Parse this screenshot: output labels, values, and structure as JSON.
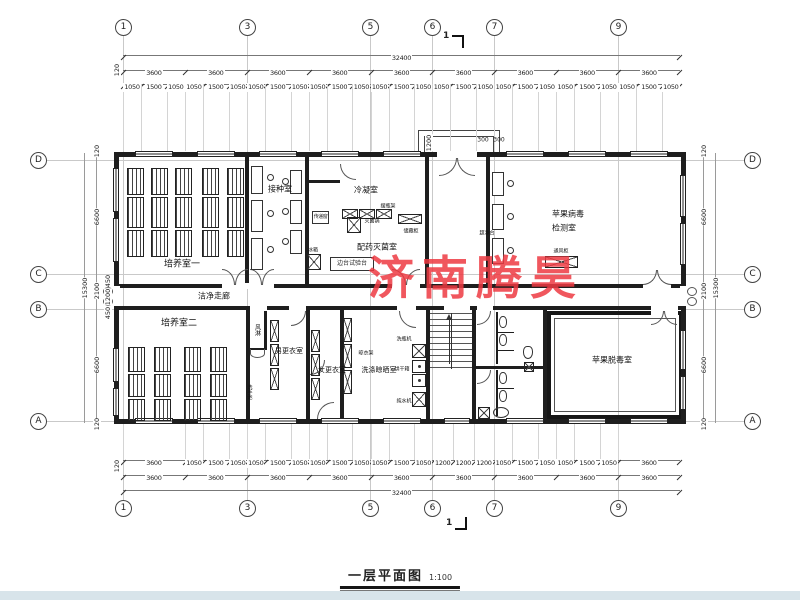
{
  "watermark": {
    "text": "济南腾昊",
    "color": "#ee3a42"
  },
  "title": {
    "name": "一层平面图",
    "scale": "1:100"
  },
  "section_mark": {
    "label": "1"
  },
  "axes": {
    "cols": [
      "1",
      "3",
      "5",
      "6",
      "7",
      "9"
    ],
    "rows": [
      "D",
      "C",
      "B",
      "A"
    ]
  },
  "dims": {
    "top": {
      "total": "32400",
      "edge": "120",
      "bays": [
        "3600",
        "3600",
        "3600",
        "3600",
        "3600",
        "3600",
        "3600",
        "3600",
        "3600"
      ],
      "fine": [
        "1050",
        "1500",
        "1050",
        "1050",
        "1500",
        "1050",
        "1050",
        "1500",
        "1050",
        "1050",
        "1500",
        "1050",
        "1050",
        "1500",
        "1050",
        "1050",
        "1500",
        "1050",
        "1050",
        "1500",
        "1050",
        "1050",
        "1500",
        "1050",
        "1050",
        "1500",
        "1050"
      ]
    },
    "bottom": {
      "total": "32400",
      "edge": "120",
      "bays": [
        "3600",
        "3600",
        "3600",
        "3600",
        "3600",
        "3600",
        "3600",
        "3600",
        "3600"
      ],
      "fine": [
        "3600",
        "1050",
        "1500",
        "1050",
        "1050",
        "1500",
        "1050",
        "1050",
        "1500",
        "1050",
        "1050",
        "1500",
        "1050",
        "1200",
        "1200",
        "1200",
        "1050",
        "1500",
        "1050",
        "1050",
        "1500",
        "1050",
        "3600"
      ]
    },
    "left": {
      "edge_top": "120",
      "d_to_c": "6600",
      "c_to_b": "2100",
      "b_to_a": "6600",
      "edge_bottom": "120",
      "total": "15300",
      "sub": [
        "450",
        "1200",
        "450"
      ]
    },
    "right": {
      "edge_top": "120",
      "d_to_c": "6600",
      "c_to_b": "2100",
      "b_to_a": "6600",
      "edge_bottom": "120",
      "total": "15300"
    },
    "porch": {
      "depth": "1200",
      "col1": "300",
      "col2": "300"
    }
  },
  "rooms": {
    "culture1": "培养室一",
    "inoculation": "接种室",
    "condensing": "冷凝室",
    "prep": "配药灭菌室",
    "virus_test_line1": "苹果病毒",
    "virus_test_line2": "检测室",
    "corridor": "洁净走廊",
    "culture2": "培养室二",
    "men_change": "男更衣室",
    "women_change": "女更衣室",
    "washing": "洗涤晾晒室",
    "detox": "苹果脱毒室"
  },
  "equipment": {
    "pass_box": "传递窗",
    "fridge": "冰箱",
    "sterilizer": "灭菌锅",
    "bottle_rack": "摆瓶架",
    "storage": "储藏柜",
    "bench": "边台试验台",
    "clean_bench": "超净台",
    "fume_hood": "通风柜",
    "air_shower": "风淋",
    "bottle_washer": "洗瓶机",
    "oven": "烘干箱",
    "water": "纯水机",
    "dry_rack": "晾衣架",
    "wash_basin": "洗手池"
  }
}
